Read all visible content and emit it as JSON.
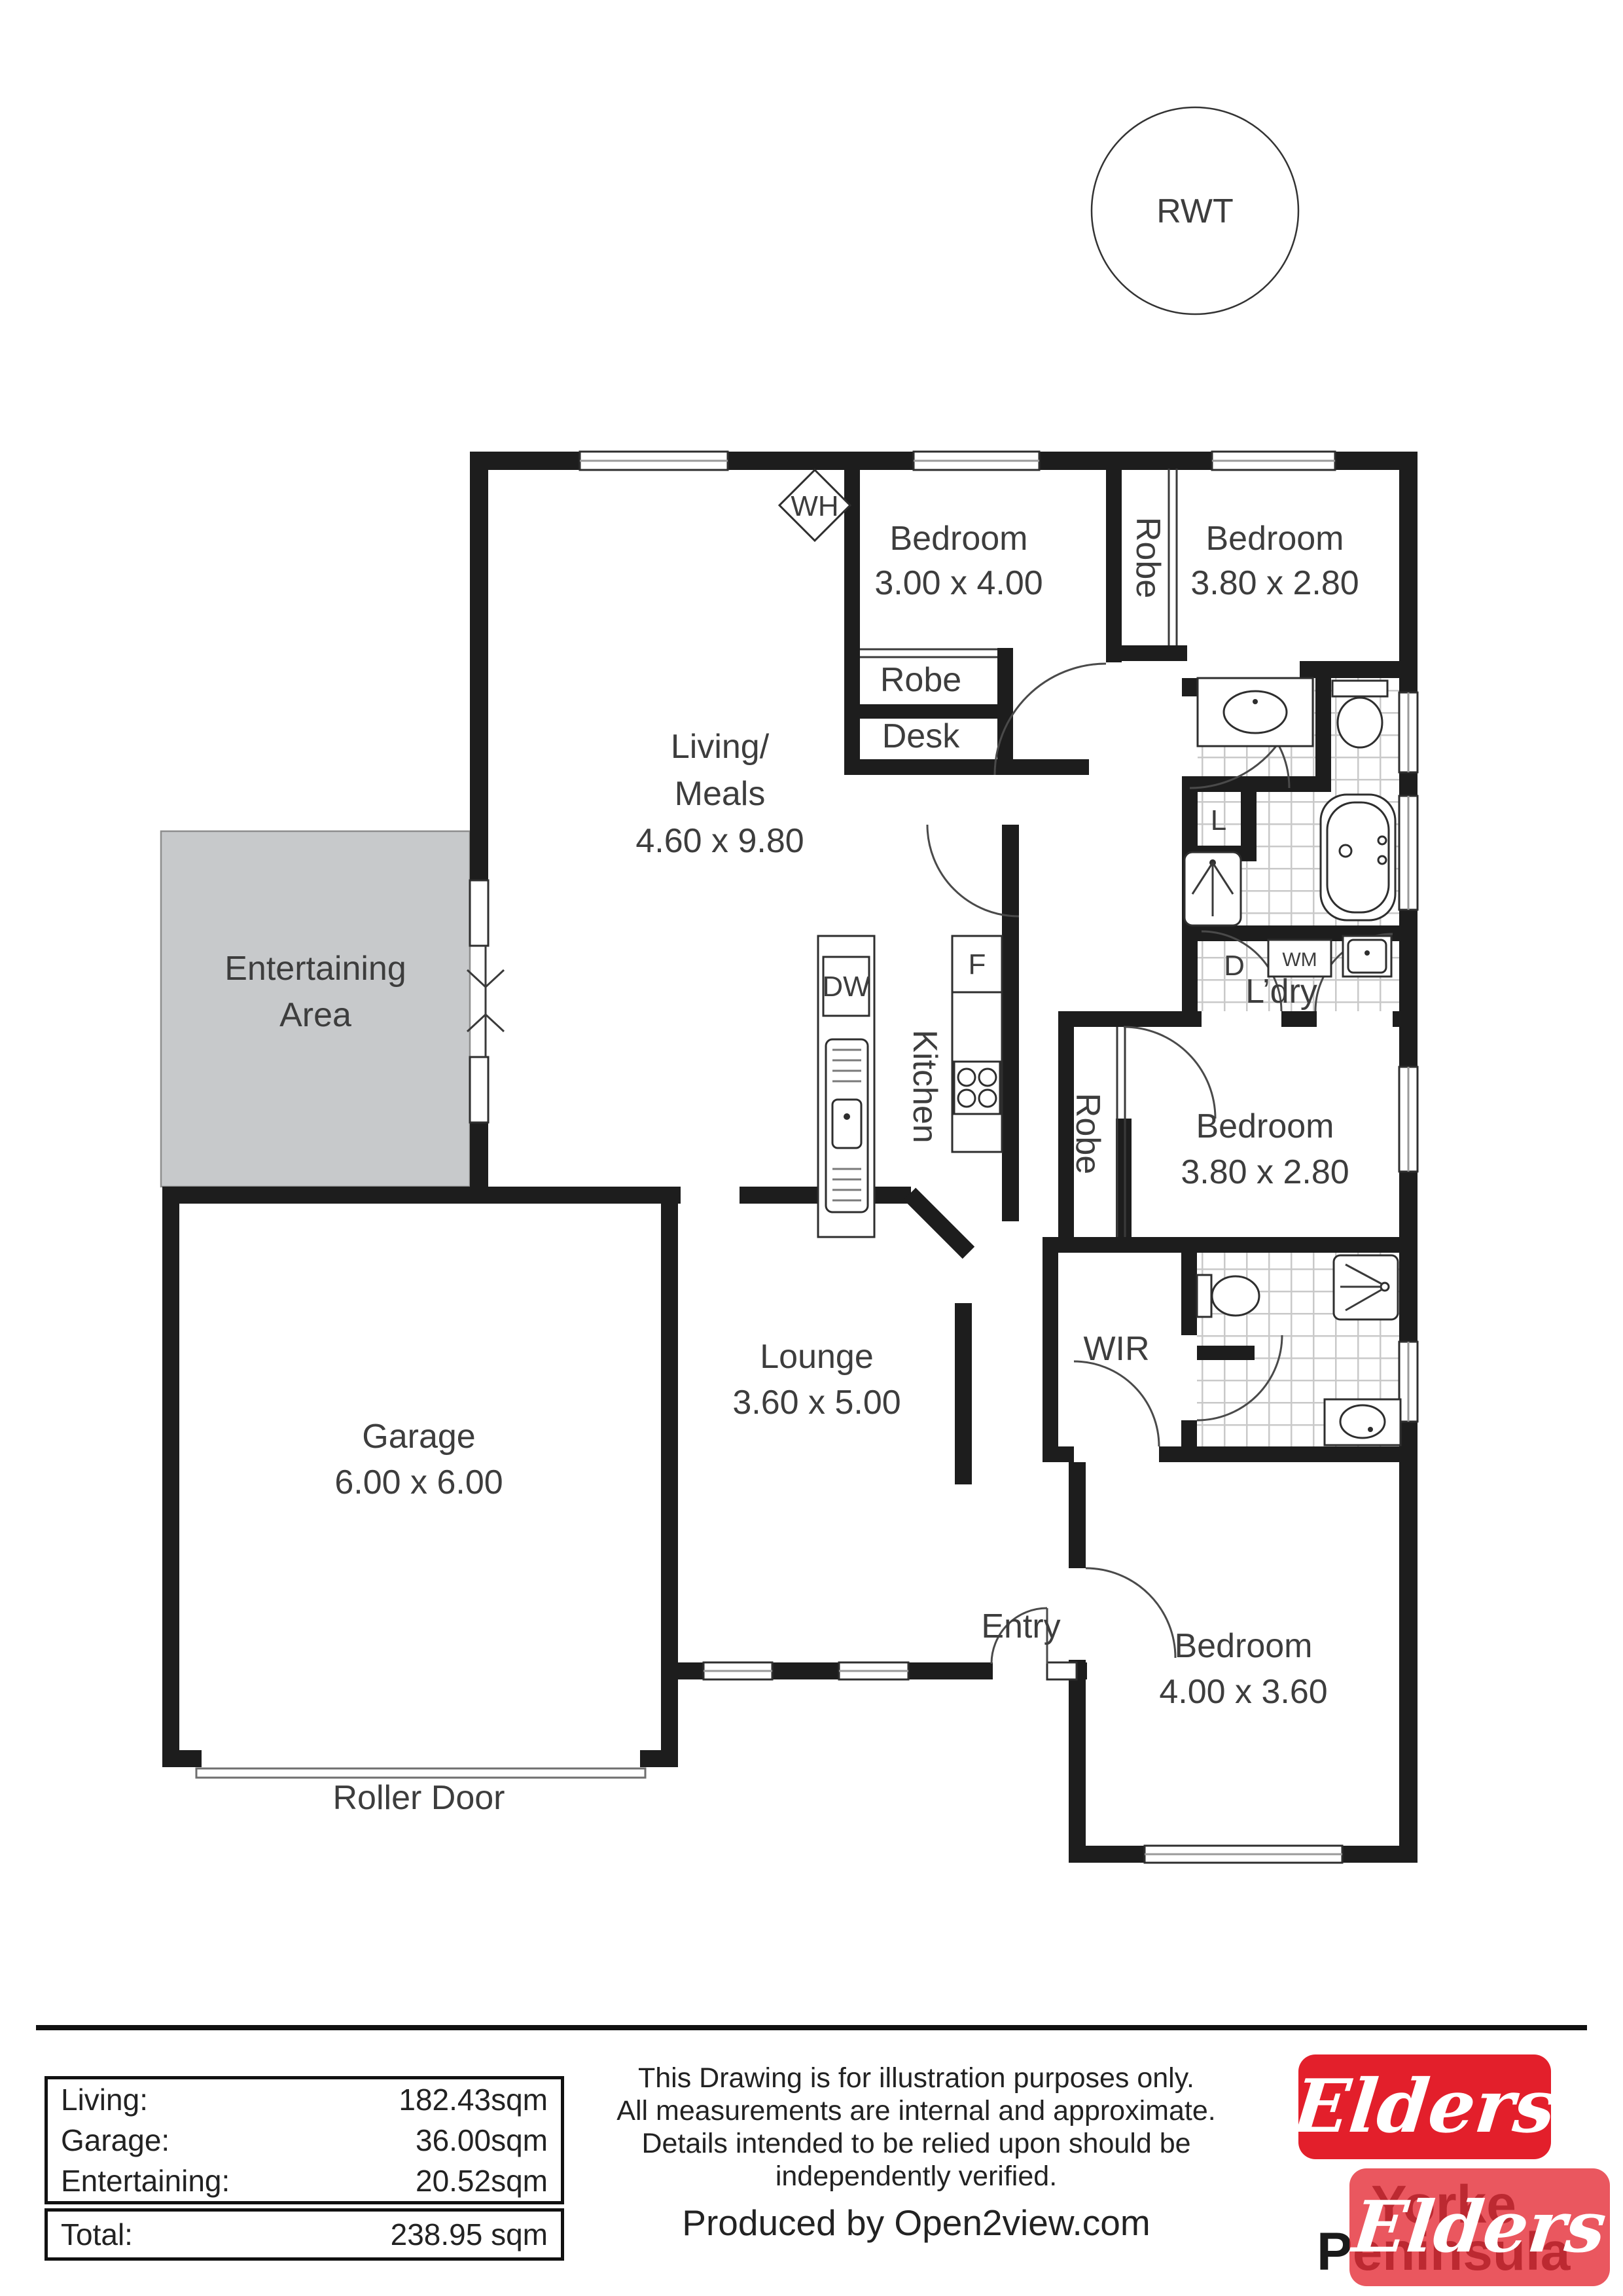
{
  "rwt_label": "RWT",
  "plan": {
    "living": {
      "l1": "Living/",
      "l2": "Meals",
      "dim": "4.60 x 9.80"
    },
    "bedroom_top_left": {
      "name": "Bedroom",
      "dim": "3.00 x 4.00"
    },
    "bedroom_top_right": {
      "name": "Bedroom",
      "dim": "3.80 x 2.80"
    },
    "bedroom_mid_right": {
      "name": "Bedroom",
      "dim": "3.80 x 2.80"
    },
    "bedroom_bottom": {
      "name": "Bedroom",
      "dim": "4.00 x 3.60"
    },
    "lounge": {
      "name": "Lounge",
      "dim": "3.60 x 5.00"
    },
    "garage": {
      "name": "Garage",
      "dim": "6.00 x 6.00"
    },
    "entertaining": {
      "l1": "Entertaining",
      "l2": "Area"
    },
    "kitchen": "Kitchen",
    "entry": "Entry",
    "wir": "WIR",
    "ldry": "L’dry",
    "robe1": "Robe",
    "robe2": "Robe",
    "robe3": "Robe",
    "desk": "Desk",
    "wh": "WH",
    "dw": "DW",
    "fridge": "F",
    "linen": "L",
    "dryer": "D",
    "wm": "WM",
    "roller_door": "Roller Door"
  },
  "areas": {
    "rows": [
      {
        "label": "Living:",
        "value": "182.43sqm"
      },
      {
        "label": "Garage:",
        "value": "36.00sqm"
      },
      {
        "label": "Entertaining:",
        "value": "20.52sqm"
      }
    ],
    "total": {
      "label": "Total:",
      "value": "238.95 sqm"
    }
  },
  "disclaimer": {
    "lines": [
      "This Drawing is for illustration purposes only.",
      "All measurements are internal and  approximate.",
      "Details intended to be relied upon should be",
      "independently verified."
    ],
    "produced": "Produced by Open2view.com"
  },
  "branding": {
    "elders": "Elders",
    "region_line1": "Yorke",
    "region_line2": "Peninsula",
    "brand_red": "#e31f2b"
  }
}
